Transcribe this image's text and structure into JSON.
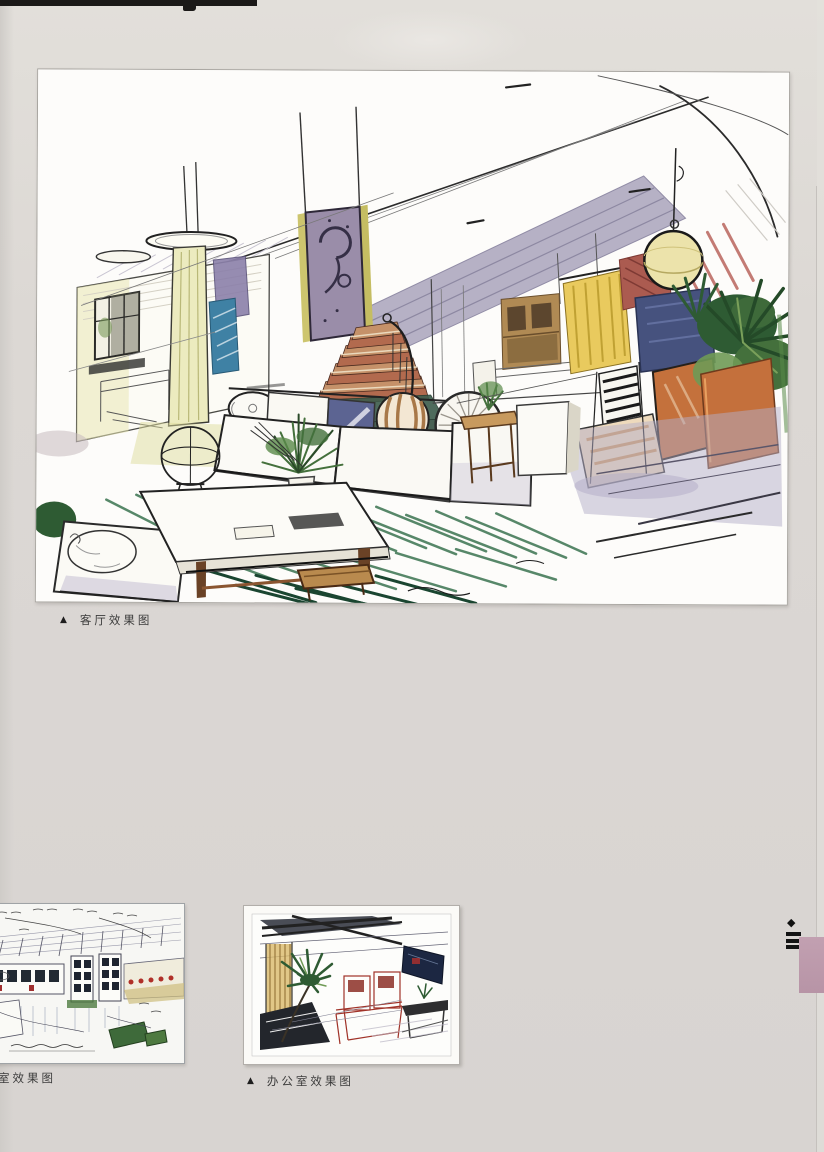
{
  "page": {
    "width": 824,
    "height": 1152,
    "background": "#dcd8d4",
    "description_domain": "scanned book page of hand-drawn interior renderings"
  },
  "figures": {
    "living_room": {
      "caption_marker": "▲",
      "caption": "客厅效果图"
    },
    "meeting_room": {
      "caption": "室效果图"
    },
    "office": {
      "caption_marker": "▲",
      "caption": "办公室效果图"
    }
  },
  "edge_marks": {
    "diamond_glyph": "◆",
    "menu_bar_count": 3,
    "tab_color": "#c2a0b1"
  },
  "palette": {
    "page_background": "#dcd8d4",
    "panel_white": "#fbfaf7",
    "caption_text": "#3b3b3b",
    "ink": "#222222",
    "edge_tab_pink": "#c2a0b1",
    "marker_green_dark": "#2e5b33",
    "marker_green_carpet": "#2e6b45",
    "marker_orange": "#c4713c",
    "marker_maroon": "#ab5b50",
    "marker_blue_panel": "#46527e",
    "marker_teal_panel": "#3f81a4",
    "marker_yellow": "#e9ca5e",
    "marker_lavender": "#b3adc8",
    "stair_red": "#b26a4e",
    "spiral_panel_purple": "#9a8da9"
  }
}
